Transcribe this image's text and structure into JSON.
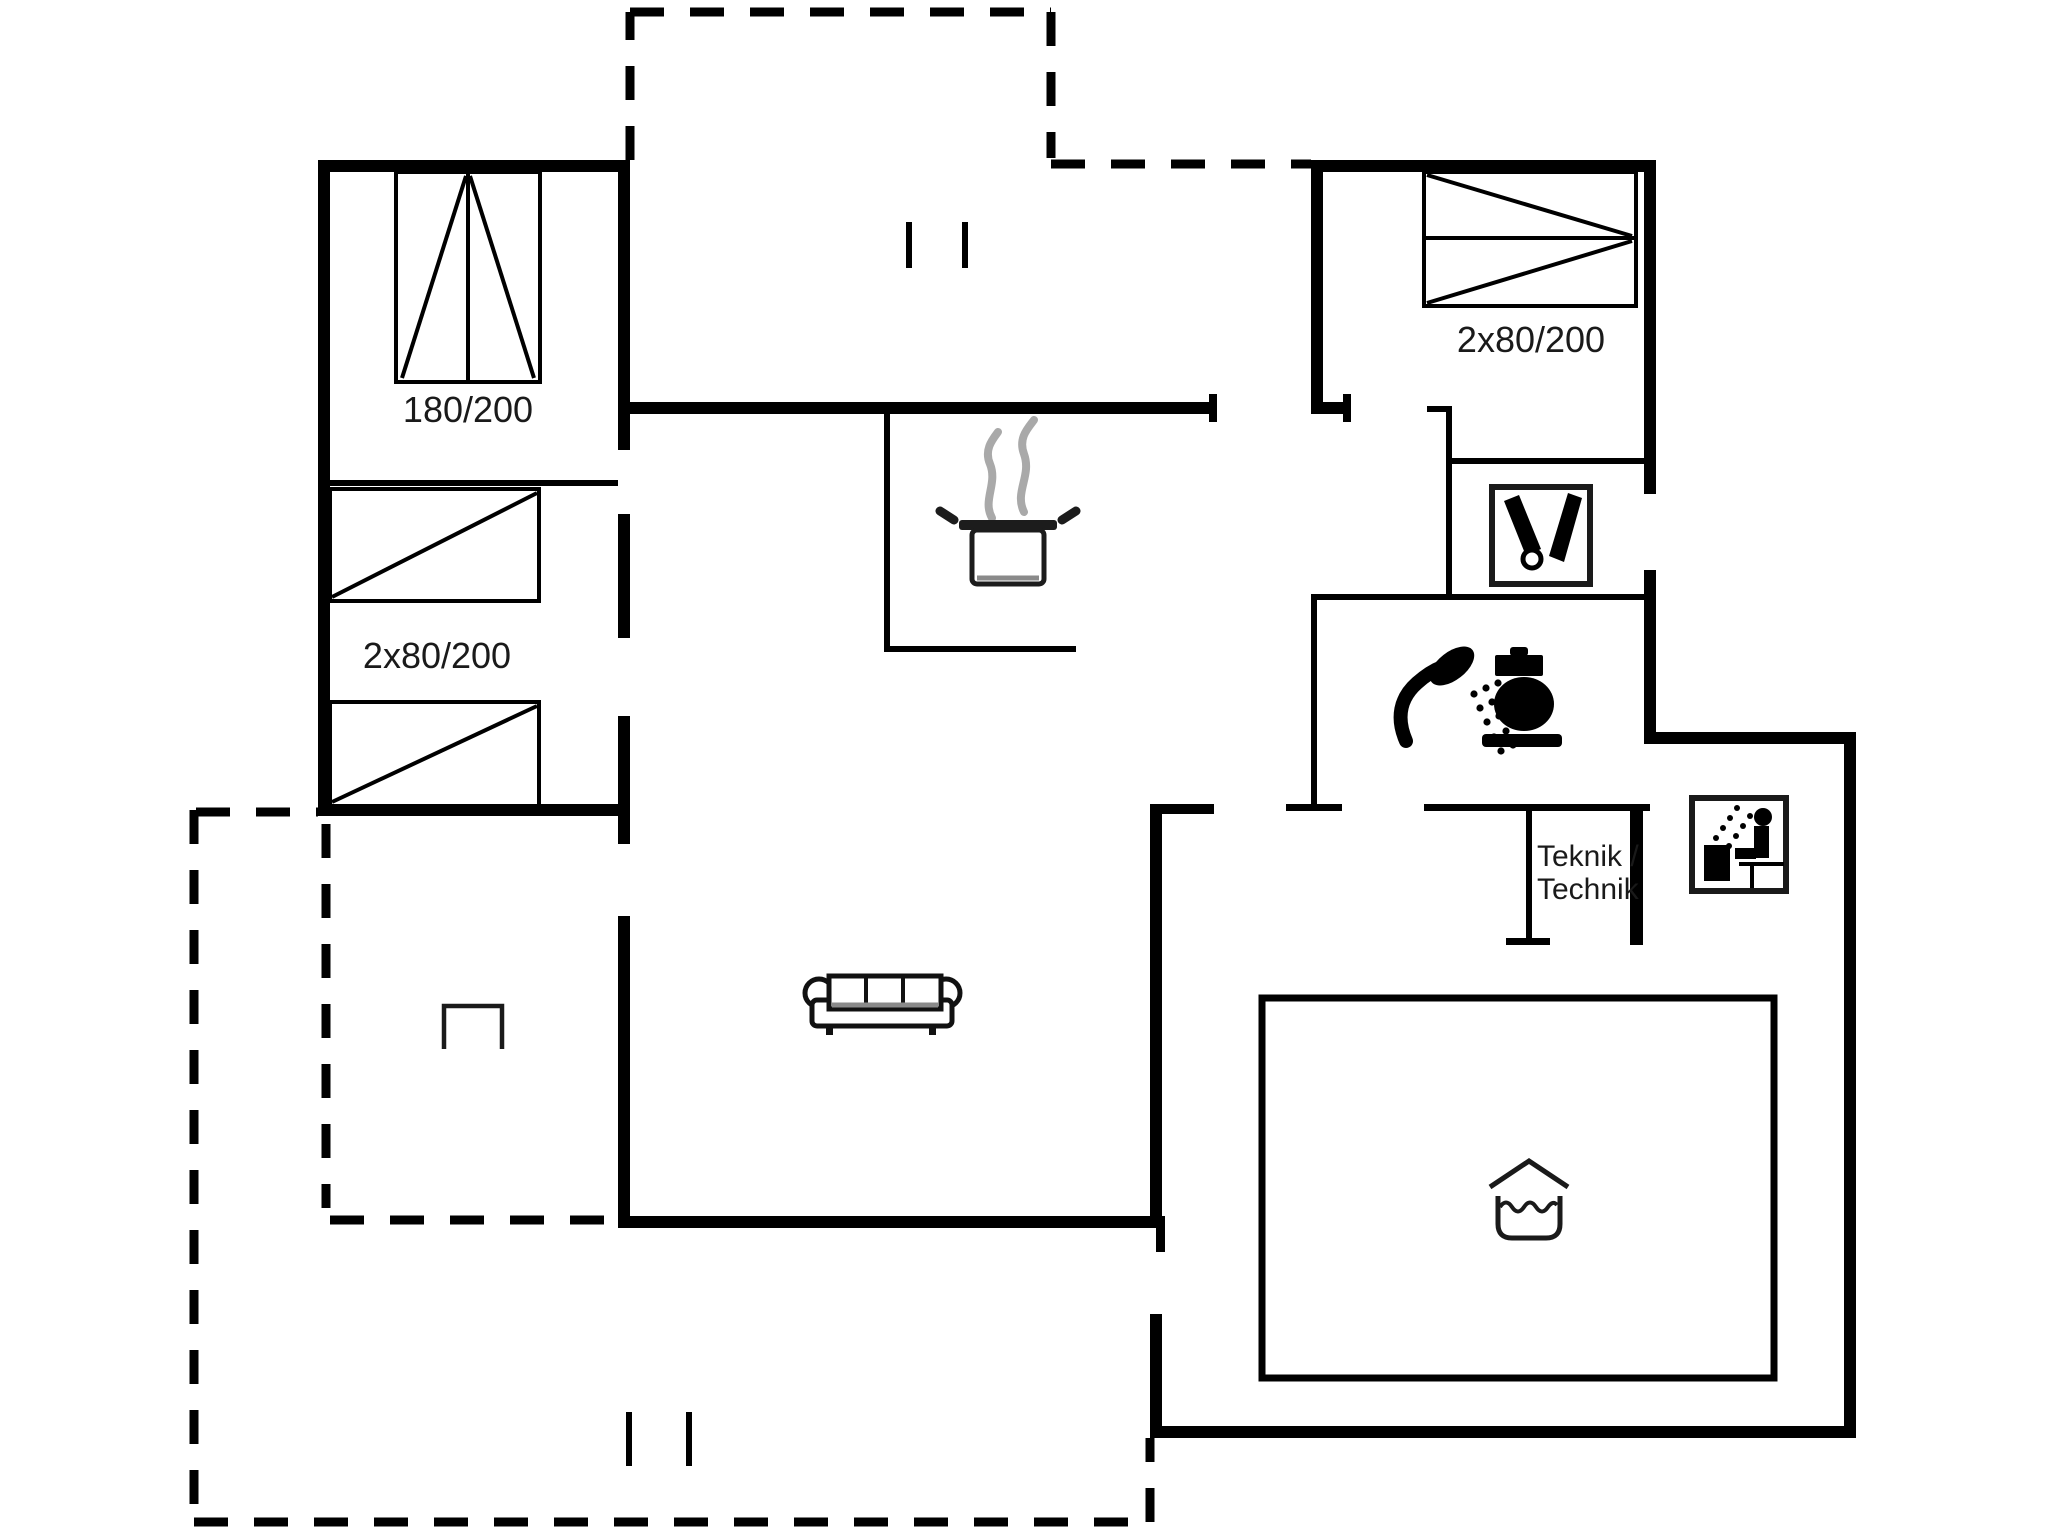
{
  "title": "Holiday house floor plan",
  "labels": {
    "bed_double": "180/200",
    "bed_twin_left": "2x80/200",
    "bed_twin_right": "2x80/200",
    "teknik_line1": "Teknik /",
    "teknik_line2": "Technik"
  },
  "icons": {
    "stove": "pot-with-steam",
    "shower": "shower-head-with-spray",
    "toilet": "toilet-side-view",
    "utility_sink": "sink-box-with-tap-and-brush",
    "sauna": "sauna-stove-and-seated-person",
    "indoor_pool": "water-basin-under-roof",
    "sofa": "three-seat-sofa",
    "terrace_marker": "open-rectangle-symbol",
    "double_bed": "rectangle-with-two-triangles",
    "single_beds": "rectangle-with-diagonal"
  },
  "colors": {
    "walls": "#000000",
    "background": "#ffffff",
    "steam": "#a9a9a9",
    "shade": "#8a8a8a",
    "text": "#1a1a1a"
  }
}
